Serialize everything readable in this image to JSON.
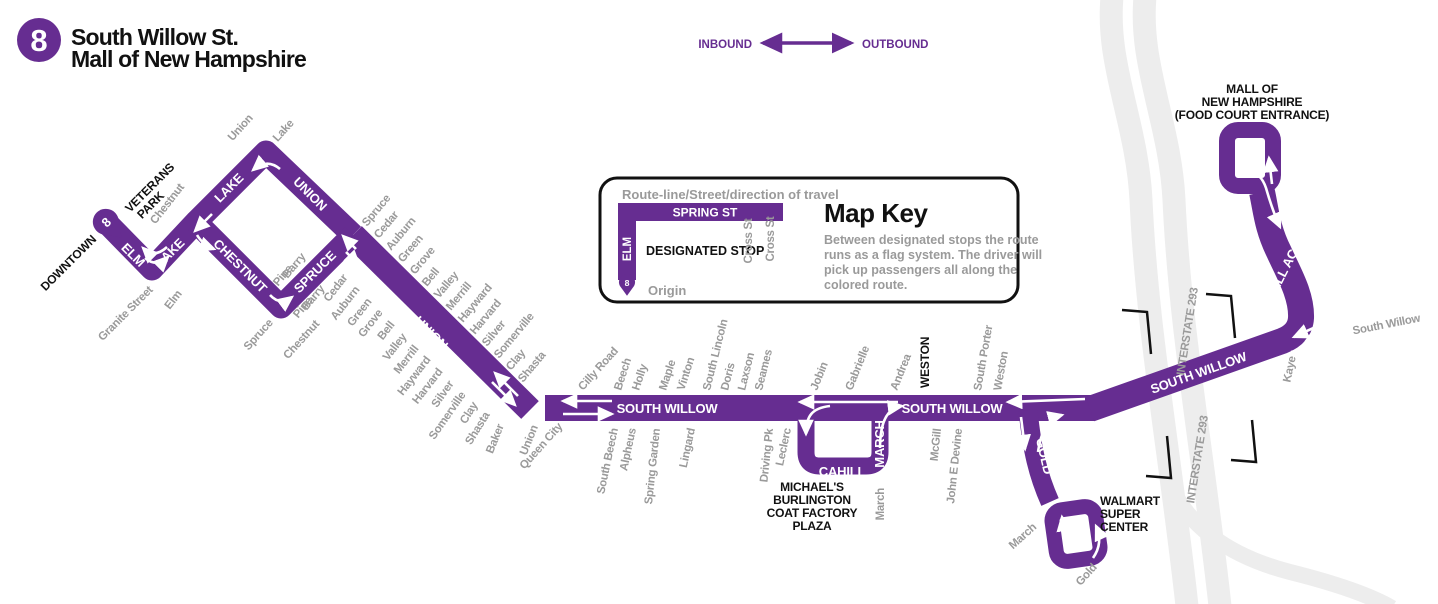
{
  "header": {
    "route_number": "8",
    "title_lines": [
      "South Willow St.",
      "Mall of New Hampshire"
    ]
  },
  "legend": {
    "inbound": "INBOUND",
    "outbound": "OUTBOUND"
  },
  "map_key": {
    "caption": "Route-line/Street/direction of travel",
    "spring_st": "SPRING ST",
    "elm": "ELM",
    "designated_stop": "DESIGNATED STOP",
    "cross_st": "Cross St",
    "origin_badge": "8",
    "origin": "Origin",
    "title": "Map Key",
    "body_lines": [
      "Between designated stops the route",
      "runs as a flag system. The driver will",
      "pick up passengers all along the",
      "colored route."
    ]
  },
  "landmarks": {
    "downtown": "DOWNTOWN",
    "veterans_park_lines": [
      "VETERANS",
      "PARK"
    ],
    "weston_stop": "WESTON",
    "michaels_lines": [
      "MICHAEL'S",
      "BURLINGTON",
      "COAT FACTORY",
      "PLAZA"
    ],
    "walmart_lines": [
      "WALMART",
      "SUPER",
      "CENTER"
    ],
    "mall_lines": [
      "MALL OF",
      "NEW HAMPSHIRE"
    ],
    "mall_sub": "(FOOD COURT ENTRANCE)"
  },
  "route_streets": {
    "elm": "ELM",
    "lake": "LAKE",
    "union": "UNION",
    "chestnut": "CHESTNUT",
    "spruce": "SPRUCE",
    "south_willow": "SOUTH WILLOW",
    "cahill": "CAHILL",
    "march": "MARCH",
    "gold": "GOLD",
    "mall_access": "MALL ACCESS",
    "origin_badge": "8"
  },
  "highways": {
    "interstate": "INTERSTATE 293"
  },
  "cross_streets": {
    "left_area": {
      "chestnut_top": "Chestnut",
      "union_top": "Union",
      "lake_top": "Lake",
      "granite": "Granite Street",
      "elm": "Elm",
      "pine_above": "Pine",
      "barry_above": "Barry",
      "pine_below": "Pine",
      "barry_below": "Barry",
      "spruce_below": "Spruce",
      "chestnut_below": "Chestnut"
    },
    "union_right": [
      "Spruce",
      "Cedar",
      "Auburn",
      "Green",
      "Grove",
      "Bell",
      "Valley",
      "Merrill",
      "Hayward",
      "Harvard",
      "Silver",
      "Somerville",
      "Clay",
      "Shasta"
    ],
    "union_left": [
      "Cedar",
      "Auburn",
      "Green",
      "Grove",
      "Bell",
      "Valley",
      "Merrill",
      "Hayward",
      "Harvard",
      "Silver",
      "Somerville",
      "Clay",
      "Shasta"
    ],
    "sw_above": [
      "Cilly Road",
      "Beech",
      "Holly",
      "Maple",
      "Vinton",
      "South Lincoln",
      "Doris",
      "Laxson",
      "Seames",
      "Jobin",
      "Gabrielle",
      "Andrea",
      "South Porter",
      "Weston"
    ],
    "sw_below": [
      "Baker",
      "Union",
      "Queen City",
      "South Beech",
      "Alpheus",
      "Spring Garden",
      "Lingard",
      "Driving Pk",
      "Leclerc",
      "McGill",
      "John E Devine"
    ],
    "march_cahill": "March",
    "march_gold": "March",
    "gold": "Gold",
    "kaye": "Kaye",
    "south_willow_cont": "South Willow"
  },
  "colors": {
    "route_purple": "#662d91",
    "label_gray": "#9a9a9a",
    "highway_gray": "#ededed",
    "black": "#111111"
  }
}
